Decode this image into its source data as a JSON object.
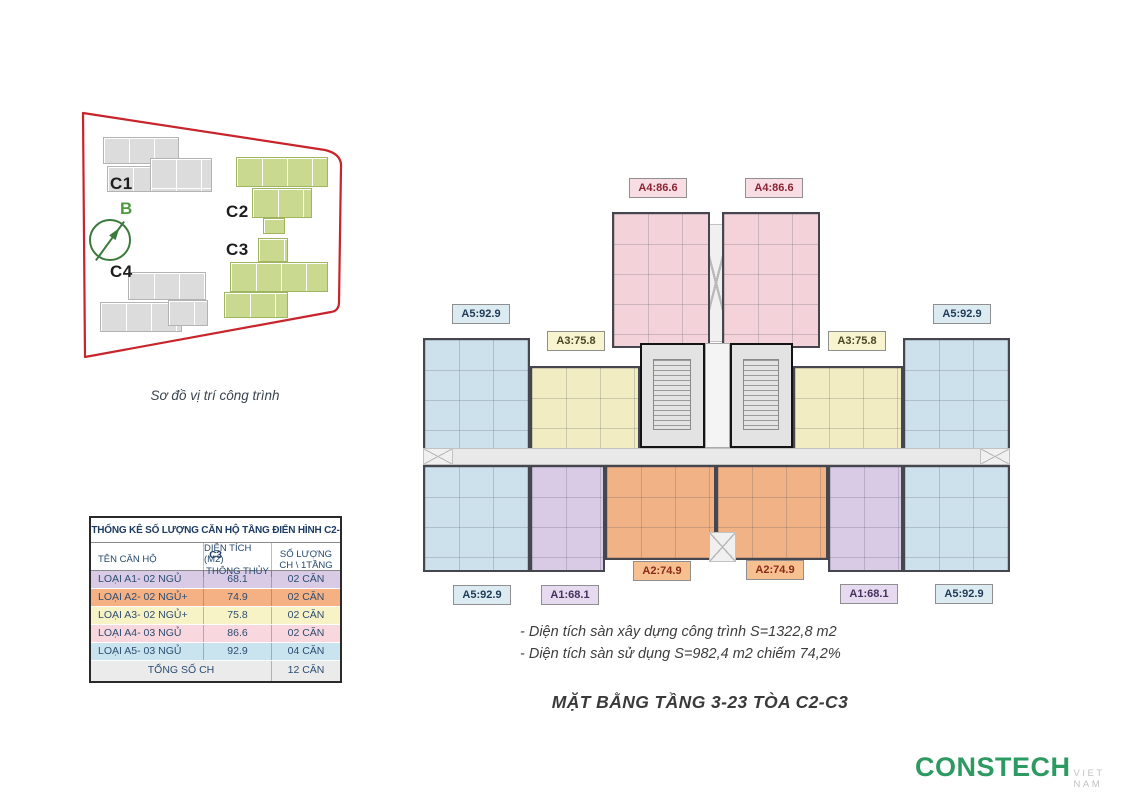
{
  "site_map": {
    "caption": "Sơ đồ vị trí công trình",
    "compass_label": "B",
    "buildings": [
      {
        "label": "C1",
        "color": "gray"
      },
      {
        "label": "C2",
        "color": "green"
      },
      {
        "label": "C3",
        "color": "green"
      },
      {
        "label": "C4",
        "color": "gray"
      }
    ]
  },
  "table": {
    "title": "THỐNG KÊ SỐ LƯỢNG CĂN HỘ TẦNG ĐIỂN HÌNH C2-C3",
    "headers": {
      "name": "TÊN CĂN HỘ",
      "area_line1": "DIỆN TÍCH (M2)",
      "area_line2": "THÔNG THỦY",
      "count_line1": "SỐ LƯỢNG",
      "count_line2": "CH \\ 1TẦNG"
    },
    "rows": [
      {
        "name": "LOẠI A1- 02 NGỦ",
        "area": "68.1",
        "count": "02 CĂN",
        "color": "#d9cbe6"
      },
      {
        "name": "LOẠI A2- 02 NGỦ+",
        "area": "74.9",
        "count": "02 CĂN",
        "color": "#f5b183"
      },
      {
        "name": "LOẠI A3- 02 NGỦ+",
        "area": "75.8",
        "count": "02 CĂN",
        "color": "#f8f3c6"
      },
      {
        "name": "LOẠI A4- 03 NGỦ",
        "area": "86.6",
        "count": "02 CĂN",
        "color": "#f8d7de"
      },
      {
        "name": "LOẠI A5- 03 NGỦ",
        "area": "92.9",
        "count": "04 CĂN",
        "color": "#c9e4ee"
      }
    ],
    "total_label": "TỔNG SỐ CH",
    "total_value": "12 CĂN"
  },
  "floor_plan": {
    "labels": [
      {
        "text": "A4:86.6",
        "unit": "A4"
      },
      {
        "text": "A4:86.6",
        "unit": "A4"
      },
      {
        "text": "A5:92.9",
        "unit": "A5"
      },
      {
        "text": "A5:92.9",
        "unit": "A5"
      },
      {
        "text": "A3:75.8",
        "unit": "A3"
      },
      {
        "text": "A3:75.8",
        "unit": "A3"
      },
      {
        "text": "A2:74.9",
        "unit": "A2"
      },
      {
        "text": "A2:74.9",
        "unit": "A2"
      },
      {
        "text": "A1:68.1",
        "unit": "A1"
      },
      {
        "text": "A1:68.1",
        "unit": "A1"
      },
      {
        "text": "A5:92.9",
        "unit": "A5"
      },
      {
        "text": "A5:92.9",
        "unit": "A5"
      }
    ]
  },
  "notes": [
    "- Diện tích sàn xây dựng công trình S=1322,8 m2",
    "- Diện tích sàn sử dụng S=982,4 m2 chiếm 74,2%"
  ],
  "title": "MẶT BẰNG TẦNG 3-23 TÒA C2-C3",
  "logo": {
    "brand": "CONSTECH",
    "suffix": "VIET NAM"
  },
  "colors": {
    "boundary_red": "#c8242b",
    "building_green": "#c9d98f",
    "building_gray": "#dcdcdc",
    "unit_a1": "#d9cbe6",
    "unit_a2": "#f1b286",
    "unit_a3": "#f1ecc2",
    "unit_a4": "#f4d2d9",
    "unit_a5": "#cde1ec",
    "core_gray": "#e3e3e3",
    "logo_green": "#2d9a62"
  }
}
